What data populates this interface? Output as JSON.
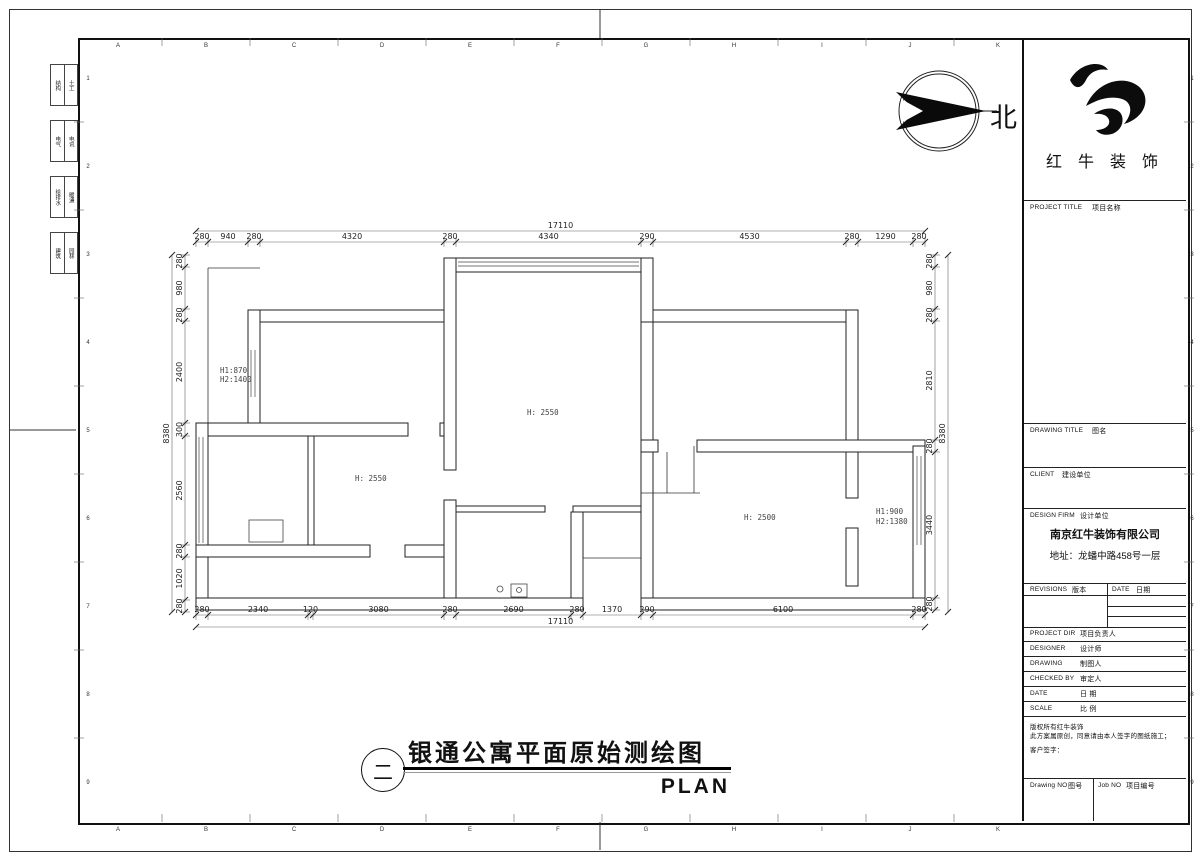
{
  "sheet": {
    "grid_letters": [
      "A",
      "B",
      "C",
      "D",
      "E",
      "F",
      "G",
      "H",
      "I",
      "J",
      "K"
    ],
    "grid_numbers": [
      "1",
      "2",
      "3",
      "4",
      "5",
      "6",
      "7",
      "8",
      "9"
    ],
    "line_color": "#222222",
    "background": "#ffffff"
  },
  "north": {
    "label": "北"
  },
  "logo": {
    "text": "红 牛 装 饰"
  },
  "title_block": {
    "project_title": {
      "en": "PROJECT TITLE",
      "zh": "项目名称"
    },
    "drawing_title": {
      "en": "DRAWING TITLE",
      "zh": "图名"
    },
    "client": {
      "en": "CLIENT",
      "zh": "建设单位"
    },
    "design_firm": {
      "en": "DESIGN FIRM",
      "zh": "设计单位"
    },
    "company": "南京红牛装饰有限公司",
    "address": "地址：龙蟠中路458号一层",
    "revisions": {
      "en": "REVISIONS",
      "zh": "版本"
    },
    "date_col": {
      "en": "DATE",
      "zh": "日期"
    },
    "rows": [
      {
        "en": "PROJECT DIR",
        "zh": "项目负责人"
      },
      {
        "en": "DESIGNER",
        "zh": "设计师"
      },
      {
        "en": "DRAWING",
        "zh": "制图人"
      },
      {
        "en": "CHECKED BY",
        "zh": "审定人"
      },
      {
        "en": "DATE",
        "zh": "日  期"
      },
      {
        "en": "SCALE",
        "zh": "比  例"
      }
    ],
    "disclaimer": [
      "版权所有红牛装饰",
      "此方案属原创，同意请由本人签字的图纸施工；",
      "客户签字："
    ],
    "drawing_no": {
      "en": "Drawing NO",
      "zh": "图号"
    },
    "job_no": {
      "en": "Job NO",
      "zh": "项目编号"
    }
  },
  "sign_off": [
    {
      "cells": [
        "结构",
        "土工"
      ]
    },
    {
      "cells": [
        "电气",
        "电讯"
      ]
    },
    {
      "cells": [
        "给排水",
        "暖通"
      ]
    },
    {
      "cells": [
        "建筑",
        "园林"
      ]
    }
  ],
  "footer": {
    "index": "二",
    "title": "银通公寓平面原始测绘图",
    "label": "PLAN"
  },
  "plan": {
    "walls": [
      [
        444,
        258,
        209,
        14
      ],
      [
        248,
        310,
        208,
        12
      ],
      [
        641,
        310,
        217,
        12
      ],
      [
        641,
        258,
        12,
        64
      ],
      [
        248,
        310,
        12,
        126
      ],
      [
        196,
        423,
        212,
        13
      ],
      [
        440,
        423,
        16,
        13
      ],
      [
        196,
        423,
        12,
        187
      ],
      [
        196,
        598,
        387,
        12
      ],
      [
        308,
        436,
        6,
        109
      ],
      [
        196,
        545,
        174,
        12
      ],
      [
        405,
        545,
        51,
        12
      ],
      [
        444,
        258,
        12,
        212
      ],
      [
        444,
        500,
        12,
        98
      ],
      [
        456,
        506,
        89,
        6
      ],
      [
        573,
        506,
        68,
        6
      ],
      [
        571,
        512,
        12,
        86
      ],
      [
        641,
        322,
        12,
        118
      ],
      [
        641,
        440,
        17,
        12
      ],
      [
        697,
        440,
        228,
        12
      ],
      [
        641,
        452,
        12,
        146
      ],
      [
        846,
        310,
        12,
        130
      ],
      [
        846,
        452,
        12,
        46
      ],
      [
        846,
        528,
        12,
        58
      ],
      [
        913,
        446,
        12,
        164
      ],
      [
        641,
        598,
        284,
        12
      ]
    ],
    "lines": [
      [
        583,
        558,
        641,
        558
      ],
      [
        583,
        558,
        583,
        598
      ],
      [
        208,
        268,
        260,
        268
      ],
      [
        208,
        268,
        208,
        423
      ],
      [
        667,
        452,
        667,
        493
      ],
      [
        641,
        493,
        700,
        493
      ],
      [
        694,
        446,
        694,
        493
      ]
    ],
    "windows": [
      [
        458,
        262,
        639,
        262
      ],
      [
        458,
        266,
        639,
        266
      ],
      [
        251,
        350,
        251,
        397
      ],
      [
        255,
        350,
        255,
        397
      ],
      [
        199,
        437,
        199,
        543
      ],
      [
        203,
        437,
        203,
        543
      ],
      [
        917,
        456,
        917,
        545
      ],
      [
        921,
        456,
        921,
        545
      ]
    ],
    "fixtures": [
      {
        "type": "circle",
        "cx": 500,
        "cy": 589,
        "r": 3
      },
      {
        "type": "rect",
        "x": 511,
        "y": 584,
        "w": 16,
        "h": 13
      },
      {
        "type": "circle",
        "cx": 519,
        "cy": 590,
        "r": 2.5
      },
      {
        "type": "rect",
        "x": 249,
        "y": 520,
        "w": 34,
        "h": 22
      }
    ],
    "labels": [
      {
        "text": "H1:870",
        "x": 220,
        "y": 373
      },
      {
        "text": "H2:1400",
        "x": 220,
        "y": 382
      },
      {
        "text": "H: 2550",
        "x": 355,
        "y": 481
      },
      {
        "text": "H: 2550",
        "x": 527,
        "y": 415
      },
      {
        "text": "H: 2500",
        "x": 744,
        "y": 520
      },
      {
        "text": "H1:900",
        "x": 876,
        "y": 514
      },
      {
        "text": "H2:1380",
        "x": 876,
        "y": 524
      }
    ],
    "dims": {
      "chains": [
        {
          "dir": "h",
          "pos": 242,
          "ticks": [
            196,
            208,
            248,
            260,
            444,
            456,
            641,
            653,
            846,
            858,
            913,
            925
          ],
          "labels": [
            "280",
            "940",
            "280",
            "4320",
            "280",
            "4340",
            "290",
            "4530",
            "280",
            "1290",
            "280"
          ]
        },
        {
          "dir": "h",
          "pos": 615,
          "ticks": [
            196,
            208,
            308,
            313,
            444,
            456,
            571,
            583,
            641,
            653,
            913,
            925
          ],
          "labels": [
            "280",
            "2340",
            "120",
            "3080",
            "280",
            "2690",
            "280",
            "1370",
            "290",
            "6100",
            "280"
          ]
        },
        {
          "dir": "v",
          "pos": 185,
          "ticks": [
            255,
            267,
            309,
            321,
            423,
            436,
            545,
            557,
            600,
            612
          ],
          "labels": [
            "280",
            "980",
            "280",
            "2400",
            "300",
            "2560",
            "280",
            "1020",
            "280"
          ]
        },
        {
          "dir": "v",
          "pos": 935,
          "ticks": [
            255,
            267,
            309,
            321,
            440,
            452,
            598,
            610
          ],
          "labels": [
            "280",
            "980",
            "280",
            "2810",
            "280",
            "3440",
            "280"
          ]
        }
      ],
      "overalls": [
        {
          "dir": "h",
          "pos": 231,
          "a": 196,
          "b": 925,
          "label": "17110"
        },
        {
          "dir": "h",
          "pos": 627,
          "a": 196,
          "b": 925,
          "label": "17110"
        },
        {
          "dir": "v",
          "pos": 172,
          "a": 255,
          "b": 612,
          "label": "8380"
        },
        {
          "dir": "v",
          "pos": 948,
          "a": 255,
          "b": 612,
          "label": "8380"
        }
      ]
    }
  }
}
